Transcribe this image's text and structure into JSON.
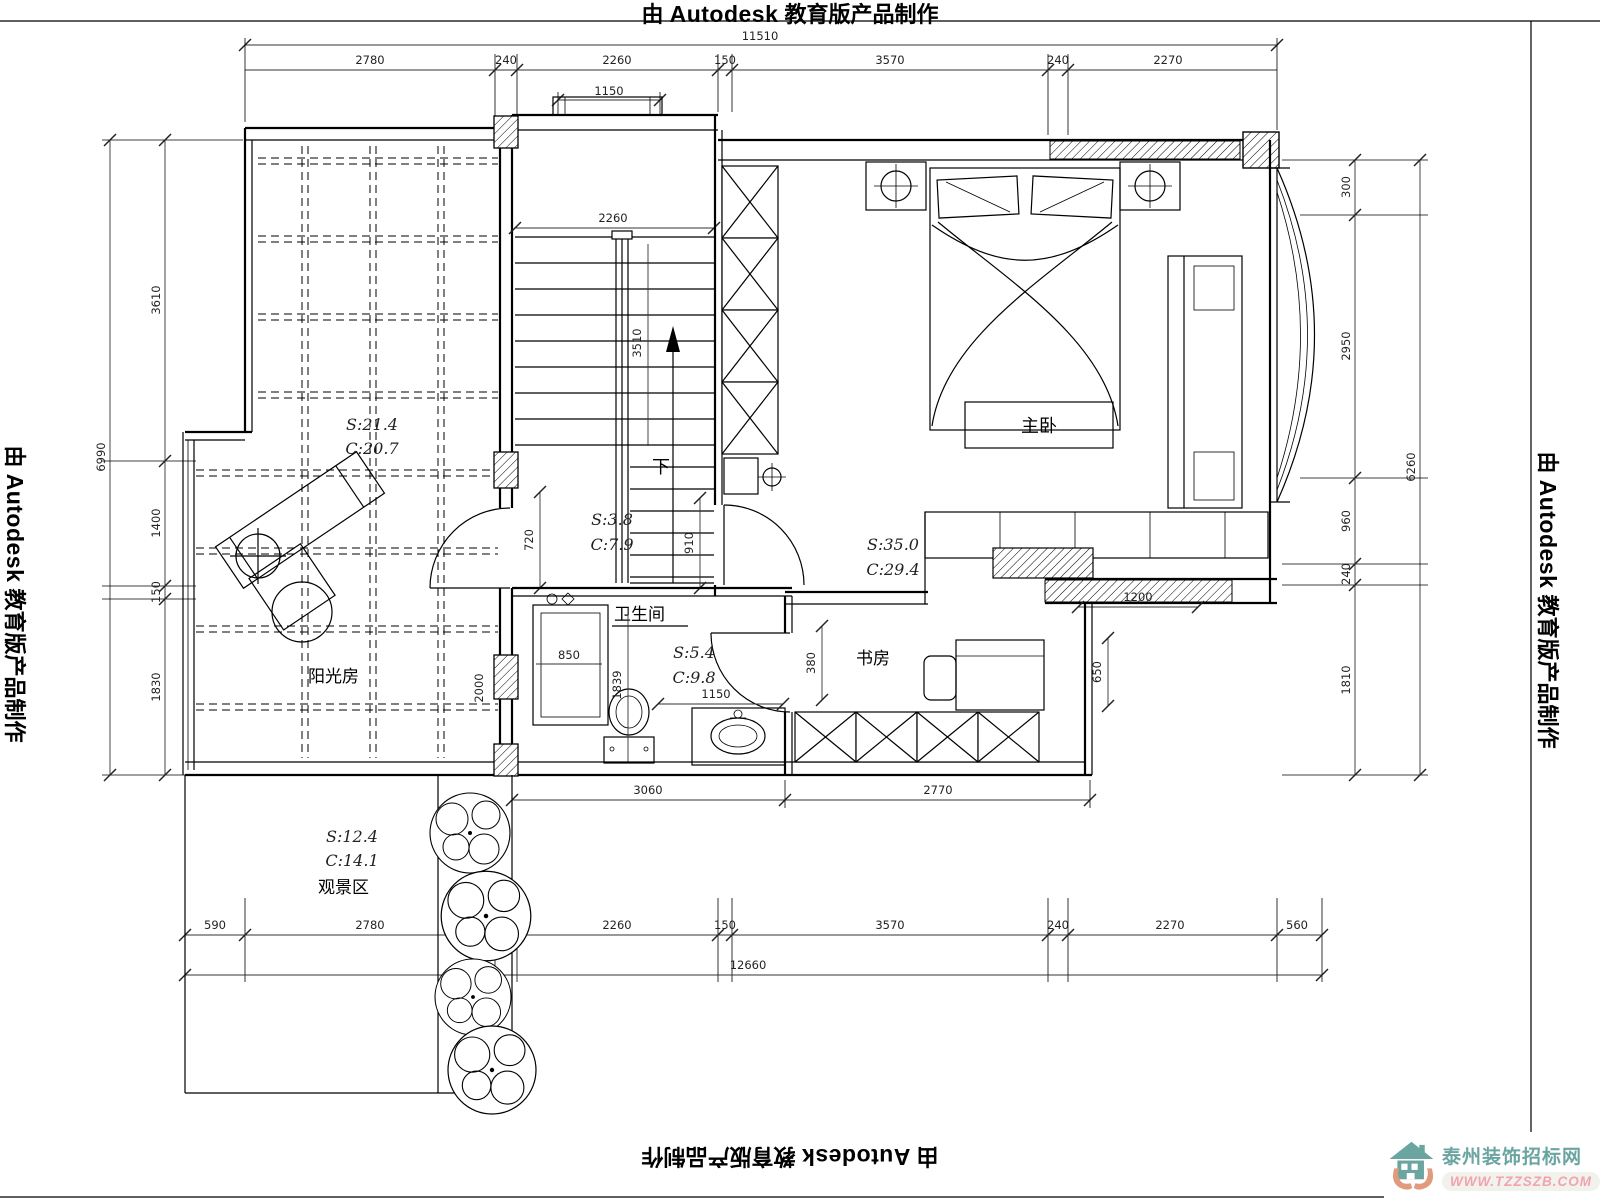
{
  "stamp": {
    "prefix": "由",
    "brand": "Autodesk",
    "suffix": "教育版产品制作"
  },
  "logo": {
    "name": "泰州装饰招标网",
    "url": "WWW.TZZSZB.COM"
  },
  "colors": {
    "teal": "#6ba5a1",
    "tan": "#e29a7c",
    "pink": "#f2a2b0"
  },
  "rooms": {
    "sunroom": {
      "label": "阳光房",
      "s": "S:21.4",
      "c": "C:20.7"
    },
    "stairwell": {
      "s": "S:3.8",
      "c": "C:7.9",
      "down_label": "下"
    },
    "master_bedroom": {
      "label": "主卧",
      "s": "S:35.0",
      "c": "C:29.4"
    },
    "bathroom": {
      "label": "卫生间",
      "s": "S:5.4",
      "c": "C:9.8"
    },
    "study": {
      "label": "书房"
    },
    "scenic_area": {
      "label": "观景区",
      "s": "S:12.4",
      "c": "C:14.1"
    }
  },
  "dims": {
    "top_total": "11510",
    "top": [
      "2780",
      "240",
      "2260",
      "150",
      "3570",
      "240",
      "2270"
    ],
    "window_top": "1150",
    "stair_w": "2260",
    "stair_h": "3510",
    "hall_left": "720",
    "hall_right": "910",
    "bath_shower": "850",
    "bath_h": "1839",
    "bath_door": "1150",
    "bath_wall": "2000",
    "study_door": "380",
    "study_right": "650",
    "bed_cabinet": "1200",
    "mid_bottom": [
      "3060",
      "2770"
    ],
    "bottom": [
      "590",
      "2780",
      "240",
      "2260",
      "150",
      "3570",
      "240",
      "2270",
      "560"
    ],
    "bottom_total": "12660",
    "left": [
      "3610",
      "1400",
      "150",
      "1830"
    ],
    "left_total": "6990",
    "right": [
      "300",
      "2950",
      "960",
      "240",
      "1810"
    ],
    "right_total": "6260"
  }
}
